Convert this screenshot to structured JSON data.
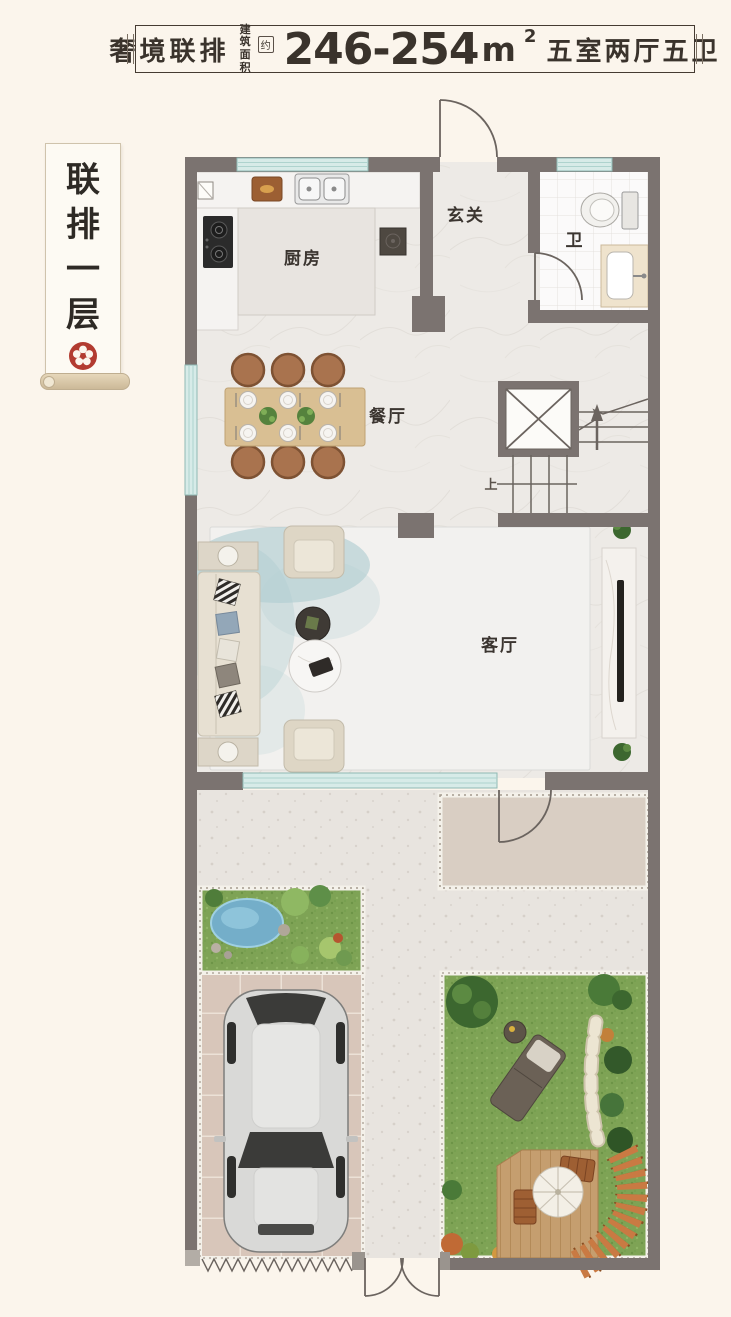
{
  "title": {
    "product": "奢境联排",
    "area_label_1": "建筑",
    "area_label_2": "面积",
    "approx": "约",
    "area_value": "246-254",
    "area_unit": "m",
    "area_exponent": "2",
    "rooms_summary": "五室两厅五卫"
  },
  "banner": {
    "chars": [
      "联",
      "排",
      "一",
      "层"
    ]
  },
  "labels": {
    "foyer": "玄关",
    "bath": "卫",
    "kitchen": "厨房",
    "dining": "餐厅",
    "living": "客厅",
    "stairs_up": "上"
  },
  "colors": {
    "background": "#fbf5ec",
    "wall": "#7b7370",
    "window_teal": "#d7ebe8",
    "seal_red": "#b23b30",
    "grass": "#7ea355",
    "pond_blue": "#74aec9",
    "wood_table": "#d9bf93"
  }
}
